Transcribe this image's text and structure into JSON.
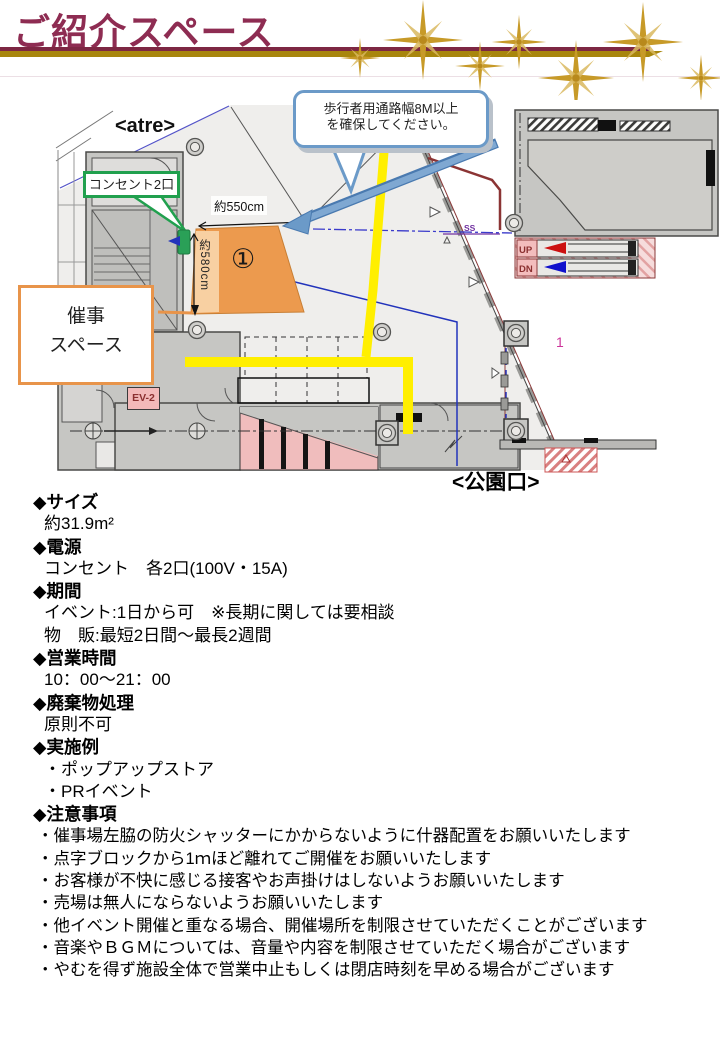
{
  "title": "ご紹介スペース",
  "colors": {
    "title_text": "#8e2c52",
    "rule_maroon": "#7d2743",
    "rule_gold": "#a8860d",
    "sparkle_gold": "#c79a28",
    "event_space_accent": "#e8944a",
    "space_fill_orange": "#ec9a4e",
    "callout_blue": "#6b9ac8",
    "callout_green": "#21a04e",
    "path_yellow": "#ffef00",
    "up_arrow_red": "#cc1111",
    "down_arrow_blue": "#1111cc"
  },
  "map": {
    "atre_label": "<atre>",
    "pedestrian_callout": {
      "line1": "歩行者用通路幅8M以上",
      "line2": "を確保してください。"
    },
    "outlet_callout": "コンセント2口",
    "width_label": "約550cm",
    "depth_label": "約580cm",
    "space_number": "①",
    "event_space_box": {
      "line1": "催事",
      "line2": "スペース"
    },
    "elevator_label": "EV-2",
    "escalator_up_label": "UP",
    "escalator_down_label": "DN",
    "ss_label": "SS",
    "area_number": "1",
    "park_exit_label": "<公園口>"
  },
  "details": {
    "sections": [
      {
        "heading": "◆サイズ",
        "lines": [
          "約31.9m²"
        ]
      },
      {
        "heading": "◆電源",
        "lines": [
          "コンセント　各2口(100V・15A)"
        ]
      },
      {
        "heading": "◆期間",
        "lines": [
          "イベント:1日から可　※長期に関しては要相談",
          "物　販:最短2日間〜最長2週間"
        ]
      },
      {
        "heading": "◆営業時間",
        "lines": [
          "10：00〜21：00"
        ]
      },
      {
        "heading": "◆廃棄物処理",
        "lines": [
          "原則不可"
        ]
      },
      {
        "heading": "◆実施例",
        "lines": [
          "・ポップアップストア",
          "・PRイベント"
        ]
      },
      {
        "heading": "◆注意事項",
        "lines": [
          "・催事場左脇の防火シャッターにかからないように什器配置をお願いいたします",
          "・点字ブロックから1ｍほど離れてご開催をお願いいたします",
          "・お客様が不快に感じる接客やお声掛けはしないようお願いいたします",
          "・売場は無人にならないようお願いいたします",
          "・他イベント開催と重なる場合、開催場所を制限させていただくことがございます",
          "・音楽やＢＧＭについては、音量や内容を制限させていただく場合がございます",
          "・やむを得ず施設全体で営業中止もしくは閉店時刻を早める場合がございます"
        ]
      }
    ]
  }
}
